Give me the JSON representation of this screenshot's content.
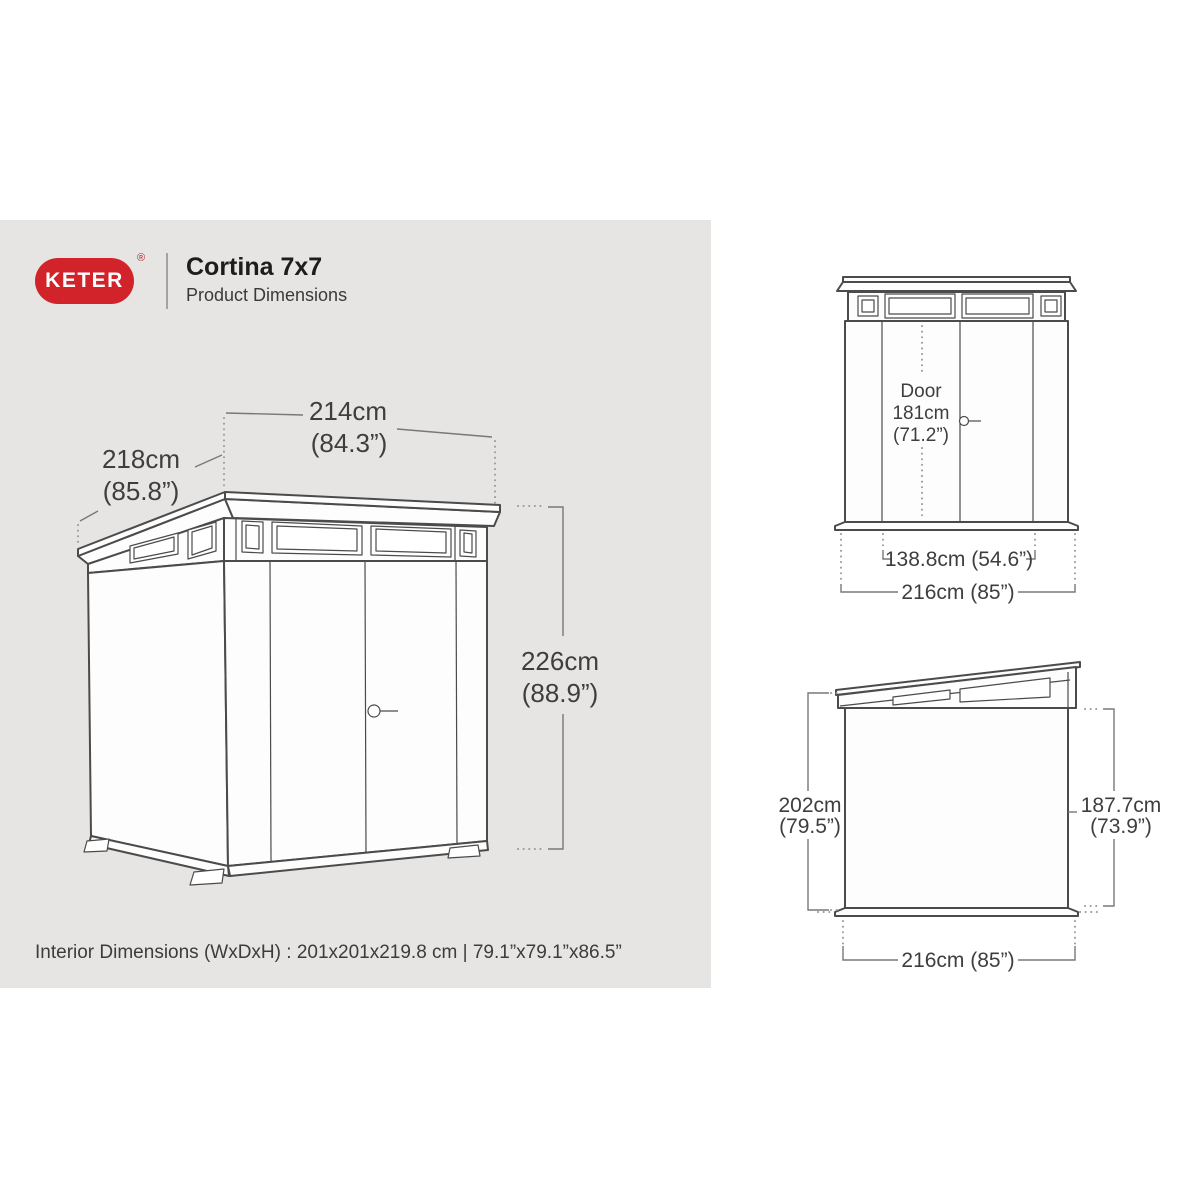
{
  "colors": {
    "panel_bg": "#e6e5e3",
    "page_bg": "#ffffff",
    "brand_red": "#d2232a",
    "line_gray": "#4b4b4b",
    "text_gray": "#3e3e3e"
  },
  "header": {
    "brand": "KETER",
    "registered_mark": "®",
    "title": "Cortina 7x7",
    "subtitle": "Product Dimensions"
  },
  "perspective_view": {
    "width_cm": "214cm",
    "width_in": "(84.3”)",
    "depth_cm": "218cm",
    "depth_in": "(85.8”)",
    "height_cm": "226cm",
    "height_in": "(88.9”)"
  },
  "front_view": {
    "door_line1": "Door",
    "door_line2": "181cm",
    "door_line3": "(71.2”)",
    "door_width": "138.8cm (54.6”)",
    "overall_width": "216cm (85”)"
  },
  "side_view": {
    "left_height_cm": "202cm",
    "left_height_in": "(79.5”)",
    "right_height_cm": "187.7cm",
    "right_height_in": "(73.9”)",
    "overall_depth": "216cm (85”)"
  },
  "footer": {
    "interior_dimensions": "Interior Dimensions (WxDxH) : 201x201x219.8 cm | 79.1”x79.1”x86.5”"
  }
}
